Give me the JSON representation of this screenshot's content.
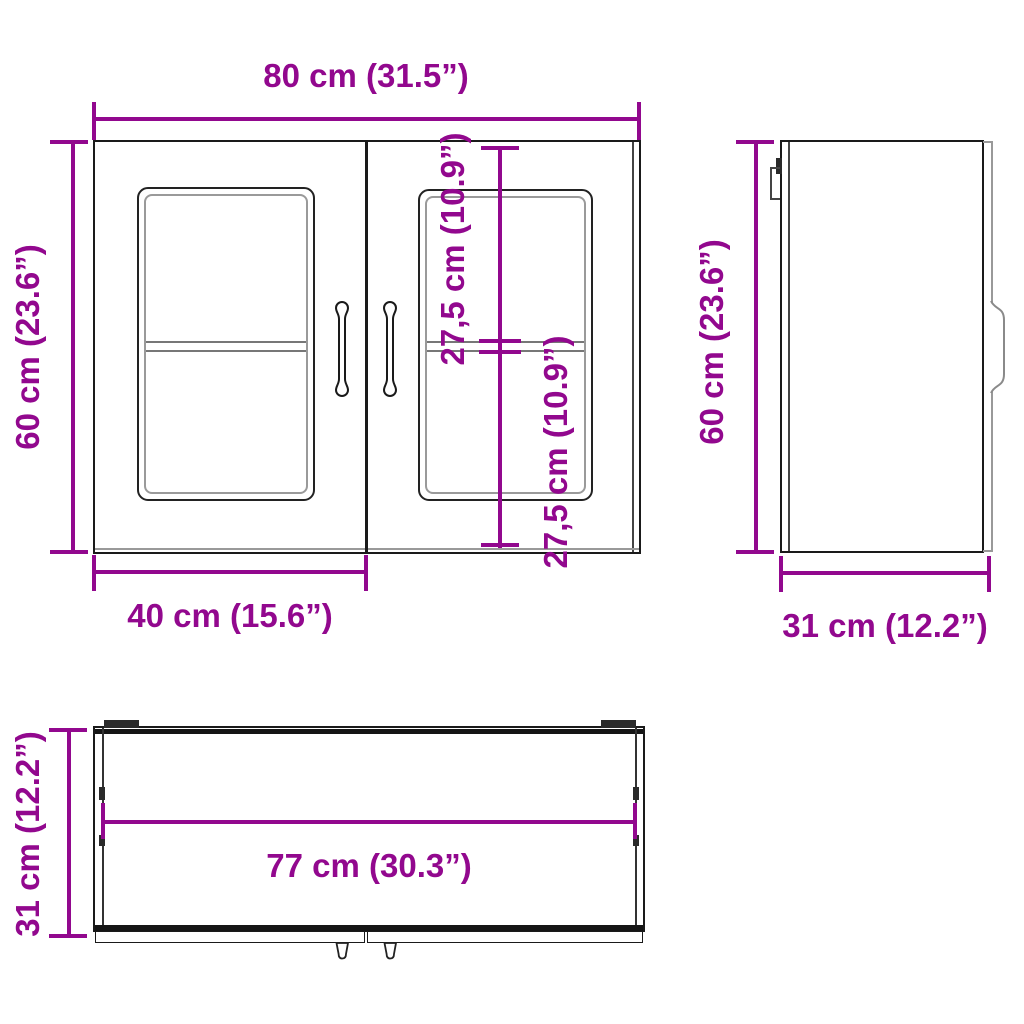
{
  "diagram_title": "wall-cabinet-dimension-diagram",
  "colors": {
    "dimension_accent": "#92088E",
    "outline": "#1a1a1a",
    "secondary_line": "#999999",
    "background": "#ffffff"
  },
  "front_view": {
    "dimensions": {
      "width": "80 cm (31.5”)",
      "height": "60 cm (23.6”)",
      "upper_section": "27,5 cm (10.9”)",
      "lower_section": "27,5 cm (10.9”)",
      "door_width": "40 cm (15.6”)"
    }
  },
  "side_view": {
    "dimensions": {
      "height": "60 cm (23.6”)",
      "depth": "31 cm (12.2”)"
    }
  },
  "top_view": {
    "dimensions": {
      "inner_width": "77 cm (30.3”)",
      "depth": "31 cm (12.2”)"
    }
  }
}
